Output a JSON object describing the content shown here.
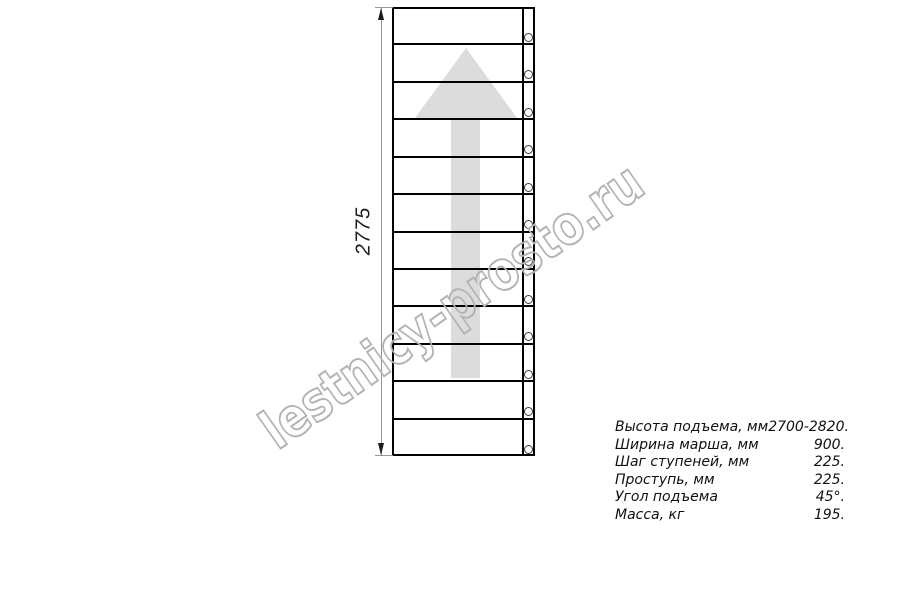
{
  "drawing": {
    "dimension_label": "2775",
    "steps": 12,
    "line_color": "#000000",
    "arrow_color": "#dcdcdc",
    "dimension_color": "#979797"
  },
  "watermark": {
    "text": "lestnicy-prosto.ru",
    "stroke_color": "#b3b3b3"
  },
  "specs": [
    {
      "label": "Высота подъема, мм",
      "value": "2700-2820."
    },
    {
      "label": "Ширина марша, мм",
      "value": "900."
    },
    {
      "label": "Шаг ступеней, мм",
      "value": "225."
    },
    {
      "label": "Проступь, мм",
      "value": "225."
    },
    {
      "label": "Угол подъема",
      "value": "45°."
    },
    {
      "label": "Масса, кг",
      "value": "195."
    }
  ]
}
